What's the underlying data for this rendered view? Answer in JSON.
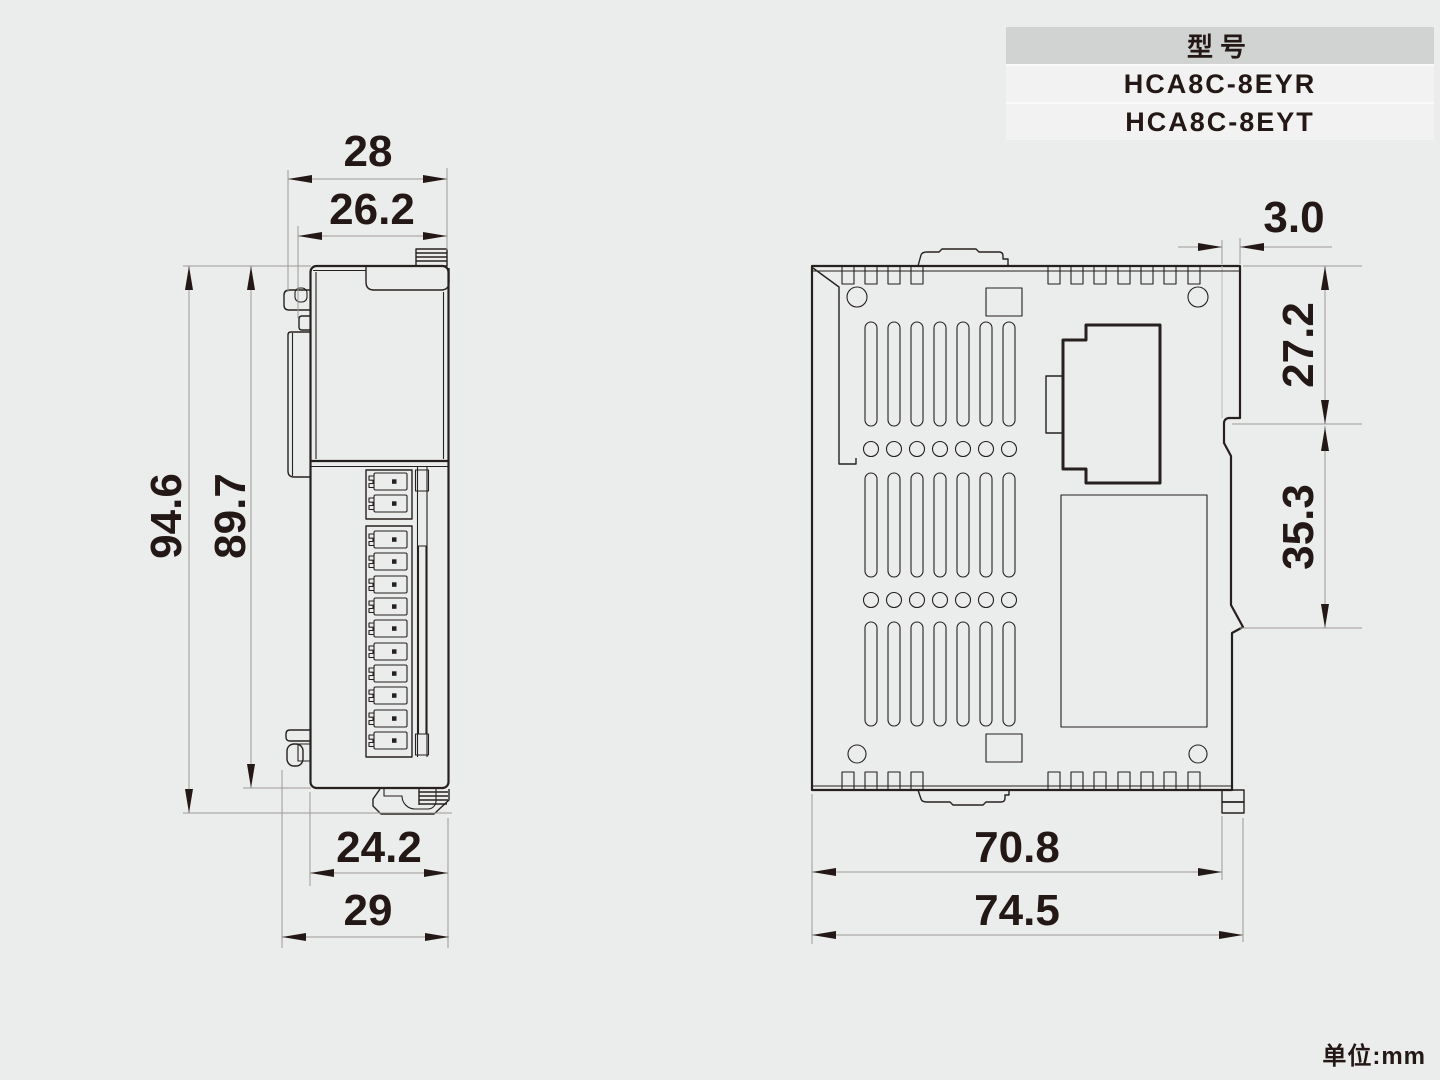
{
  "colors": {
    "page_bg": "#ebecec",
    "line": "#26211e",
    "dim_line": "#9c9a98",
    "ink": "#231815",
    "table_header_bg": "#d1d2d2",
    "table_row_bg": "#f2f2f2"
  },
  "model_table": {
    "header": "型号",
    "models": [
      "HCA8C-8EYR",
      "HCA8C-8EYT"
    ]
  },
  "front_view": {
    "dim_top_width_outer": "28",
    "dim_top_width_inner": "26.2",
    "dim_height_total": "94.6",
    "dim_height_body": "89.7",
    "dim_bottom_width_body": "24.2",
    "dim_bottom_width_outer": "29"
  },
  "side_view": {
    "dim_rail_step": "3.0",
    "dim_depth_upper": "27.2",
    "dim_depth_lower": "35.3",
    "dim_width_body": "70.8",
    "dim_width_total": "74.5"
  },
  "unit_note": "单位:mm"
}
